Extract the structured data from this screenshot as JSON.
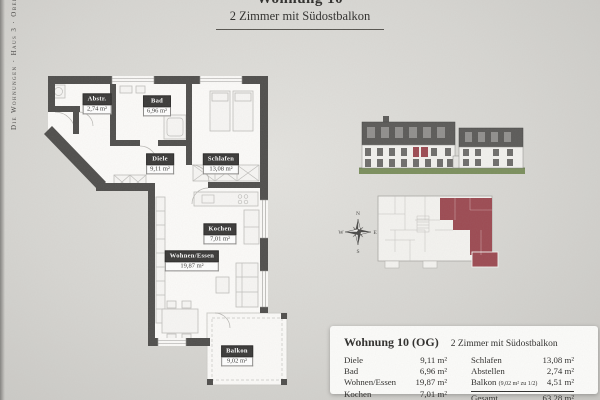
{
  "page": {
    "sidebar_text": "Die Wohnungen · Haus 3 · Obergeschoss"
  },
  "header": {
    "title": "Wohnung 10",
    "subtitle": "2 Zimmer mit Südostbalkon"
  },
  "floorplan": {
    "rooms": [
      {
        "name": "Abstr.",
        "area": "2,74 m²"
      },
      {
        "name": "Bad",
        "area": "6,96 m²"
      },
      {
        "name": "Diele",
        "area": "9,11 m²"
      },
      {
        "name": "Schlafen",
        "area": "13,08 m²"
      },
      {
        "name": "Kochen",
        "area": "7,01 m²"
      },
      {
        "name": "Wohnen/Essen",
        "area": "19,87 m²"
      },
      {
        "name": "Balkon",
        "area": "9,02 m²"
      }
    ]
  },
  "compass": {
    "north": "N",
    "east": "E",
    "south": "S",
    "west": "W"
  },
  "table": {
    "title": "Wohnung 10 (OG)",
    "subtitle": "2 Zimmer mit Südostbalkon",
    "left_rows": [
      {
        "label": "Diele",
        "value": "9,11 m²"
      },
      {
        "label": "Bad",
        "value": "6,96 m²"
      },
      {
        "label": "Wohnen/Essen",
        "value": "19,87 m²"
      },
      {
        "label": "Kochen",
        "value": "7,01 m²"
      }
    ],
    "right_rows": [
      {
        "label": "Schlafen",
        "note": "",
        "value": "13,08 m²"
      },
      {
        "label": "Abstellen",
        "note": "",
        "value": "2,74 m²"
      },
      {
        "label": "Balkon",
        "note": "(9,02 m² zu 1/2)",
        "value": "4,51 m²"
      }
    ],
    "total": {
      "label": "Gesamt",
      "value": "63,28 m²"
    }
  },
  "colors": {
    "wall": "#4f4e4c",
    "label-bg": "#3a3938",
    "accent": "#9c4a52",
    "grass": "#7b8f5d",
    "attic": "#5b5a58",
    "ink": "#2e2d2b"
  }
}
